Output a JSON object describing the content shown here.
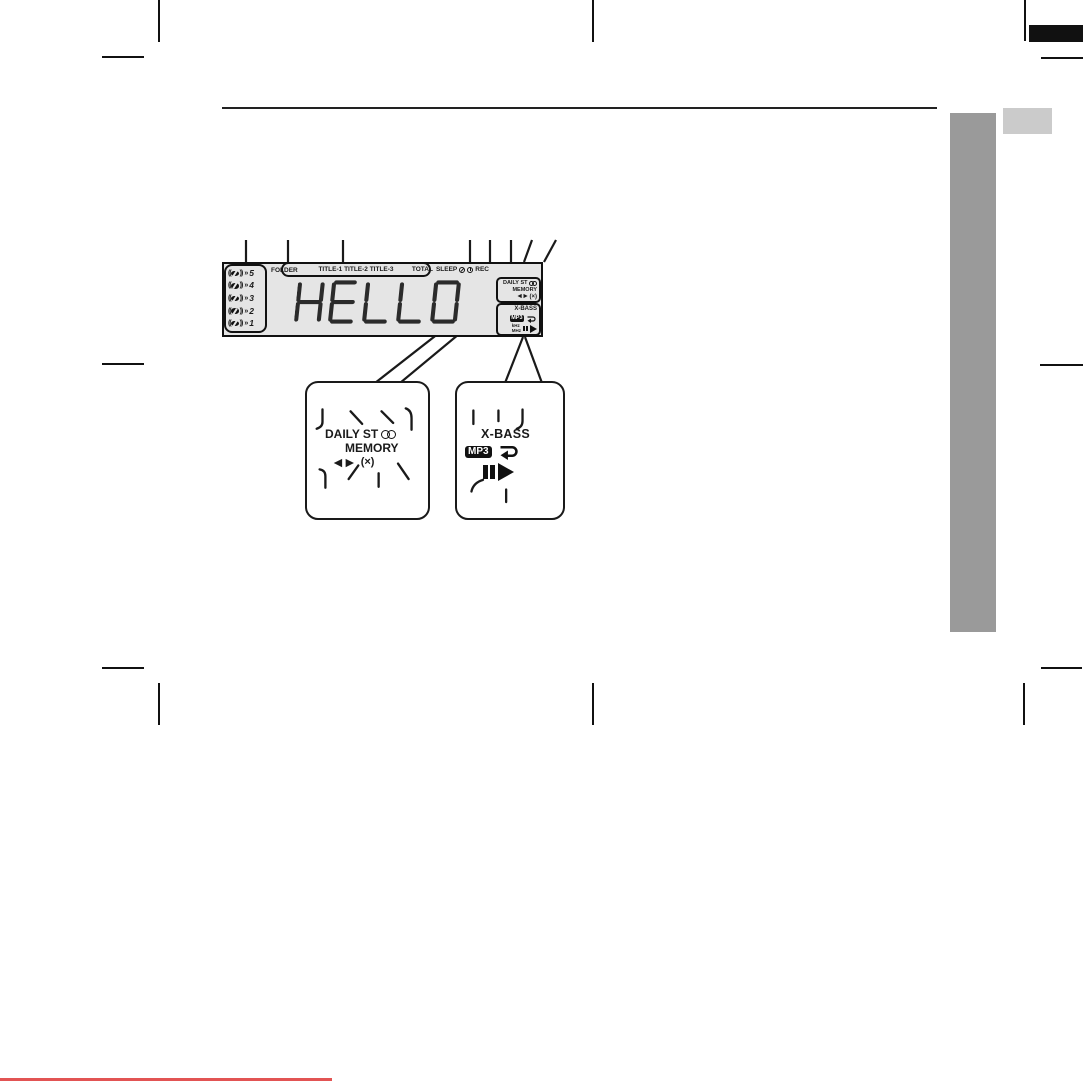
{
  "colors": {
    "accent_red": "#e25453",
    "tab_dark": "#9a9a9a",
    "tab_light": "#cbcbcb",
    "display_bg": "#e5e5e5",
    "ink": "#1a1a1a"
  },
  "display": {
    "text": "HELLO",
    "discs": [
      "5",
      "4",
      "3",
      "2",
      "1"
    ],
    "disc_paren_left": "((",
    "disc_paren_right": "))",
    "disc_chevron": "»",
    "folder": "FOLDER",
    "titles": "TITLE-1 TITLE-2 TITLE-3",
    "total": "TOTAL",
    "sleep": "SLEEP",
    "rec": "REC",
    "daily": "DAILY",
    "st": "ST",
    "memory": "MEMORY",
    "prev_next": "◄►",
    "random": "(×)",
    "xbass": "X-BASS",
    "mp3": "MP3",
    "khz": "kHz",
    "mhz": "MHz"
  },
  "callouts": {
    "left": {
      "daily": "DAILY",
      "st": "ST",
      "memory": "MEMORY",
      "prev_next": "◄►",
      "random": "(×)"
    },
    "right": {
      "xbass": "X-BASS",
      "mp3": "MP3"
    }
  }
}
